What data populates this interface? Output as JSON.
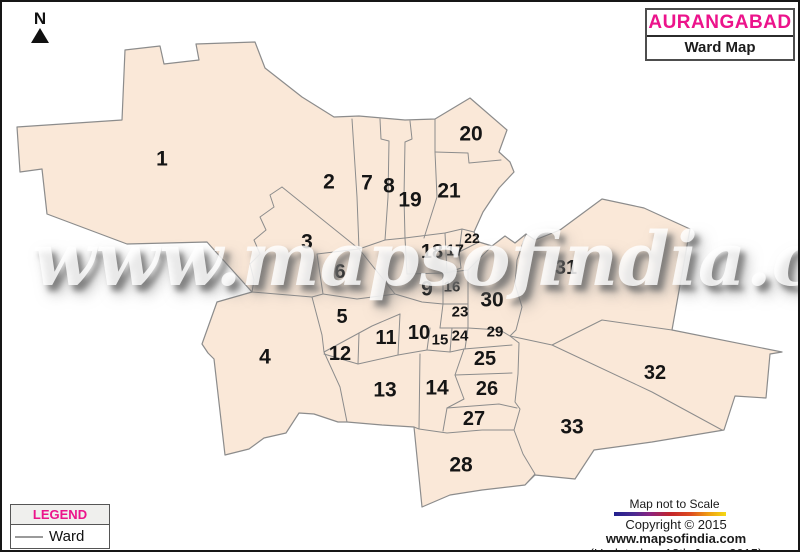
{
  "north_indicator": {
    "label": "N"
  },
  "title_box": {
    "title": "AURANGABAD",
    "subtitle": "Ward Map"
  },
  "watermark": "www.mapsofindia.com",
  "legend": {
    "header": "LEGEND",
    "items": [
      {
        "symbol": "ward-line",
        "label": "Ward"
      }
    ]
  },
  "footer": {
    "scale_note": "Map not to Scale",
    "copyright_prefix": "Copyright © 2015 ",
    "copyright_site": "www.mapsofindia.com",
    "updated": "(Updated on 18th June, 2015)"
  },
  "colors": {
    "brand_pink": "#EC138B",
    "map_fill": "#FAE8D8",
    "boundary_gray": "#8C8C8C"
  },
  "map": {
    "region_name": "Aurangabad",
    "wards": [
      {
        "id": 1,
        "x": 160,
        "y": 157,
        "fs": 21
      },
      {
        "id": 2,
        "x": 327,
        "y": 180,
        "fs": 21
      },
      {
        "id": 3,
        "x": 305,
        "y": 240,
        "fs": 21
      },
      {
        "id": 4,
        "x": 263,
        "y": 355,
        "fs": 21
      },
      {
        "id": 5,
        "x": 340,
        "y": 315,
        "fs": 20
      },
      {
        "id": 6,
        "x": 338,
        "y": 270,
        "fs": 20
      },
      {
        "id": 7,
        "x": 365,
        "y": 181,
        "fs": 21
      },
      {
        "id": 8,
        "x": 387,
        "y": 184,
        "fs": 21
      },
      {
        "id": 9,
        "x": 425,
        "y": 287,
        "fs": 21
      },
      {
        "id": 10,
        "x": 417,
        "y": 331,
        "fs": 20
      },
      {
        "id": 11,
        "x": 384,
        "y": 336,
        "fs": 20
      },
      {
        "id": 12,
        "x": 338,
        "y": 352,
        "fs": 20
      },
      {
        "id": 13,
        "x": 383,
        "y": 388,
        "fs": 21
      },
      {
        "id": 14,
        "x": 435,
        "y": 386,
        "fs": 21
      },
      {
        "id": 15,
        "x": 438,
        "y": 338,
        "fs": 15
      },
      {
        "id": 16,
        "x": 450,
        "y": 285,
        "fs": 15
      },
      {
        "id": 17,
        "x": 453,
        "y": 249,
        "fs": 16
      },
      {
        "id": 18,
        "x": 430,
        "y": 250,
        "fs": 20
      },
      {
        "id": 19,
        "x": 408,
        "y": 198,
        "fs": 21
      },
      {
        "id": 20,
        "x": 469,
        "y": 132,
        "fs": 21
      },
      {
        "id": 21,
        "x": 447,
        "y": 189,
        "fs": 21
      },
      {
        "id": 22,
        "x": 470,
        "y": 236,
        "fs": 14
      },
      {
        "id": 23,
        "x": 458,
        "y": 310,
        "fs": 15
      },
      {
        "id": 24,
        "x": 458,
        "y": 334,
        "fs": 15
      },
      {
        "id": 25,
        "x": 483,
        "y": 357,
        "fs": 20
      },
      {
        "id": 26,
        "x": 485,
        "y": 387,
        "fs": 20
      },
      {
        "id": 27,
        "x": 472,
        "y": 417,
        "fs": 20
      },
      {
        "id": 28,
        "x": 459,
        "y": 463,
        "fs": 21
      },
      {
        "id": 29,
        "x": 493,
        "y": 330,
        "fs": 15
      },
      {
        "id": 30,
        "x": 490,
        "y": 298,
        "fs": 21
      },
      {
        "id": 31,
        "x": 564,
        "y": 266,
        "fs": 20
      },
      {
        "id": 32,
        "x": 653,
        "y": 371,
        "fs": 20
      },
      {
        "id": 33,
        "x": 570,
        "y": 425,
        "fs": 21
      }
    ]
  }
}
